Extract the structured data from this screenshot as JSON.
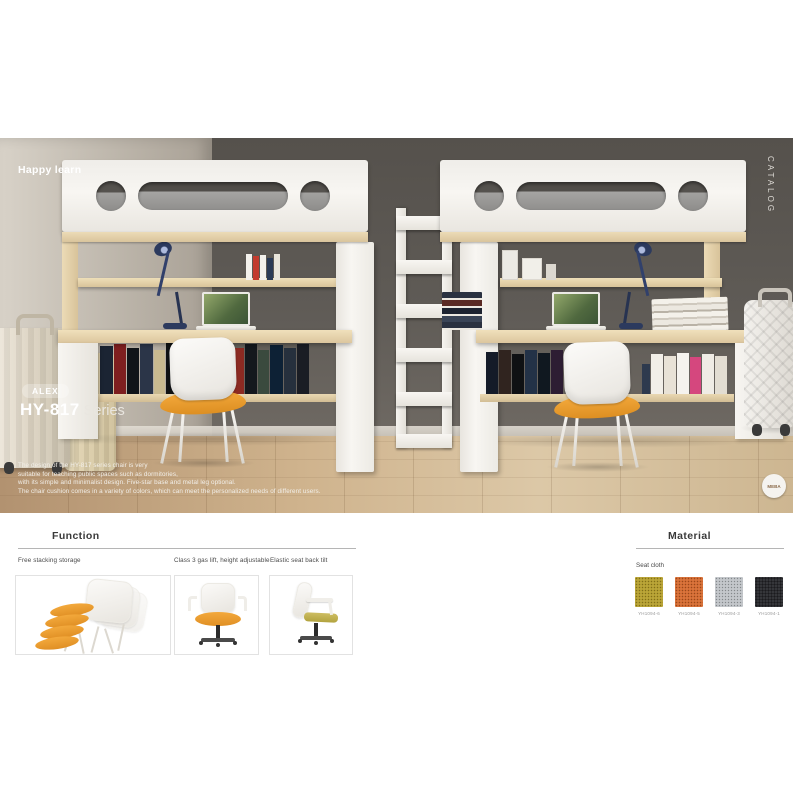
{
  "photo": {
    "tagline": "Happy learn",
    "catalog_label": "CATALOG",
    "series_badge": "ALEX",
    "series_code": "HY-817",
    "series_suffix": "Series",
    "description_lines": [
      "The design of the HY-817 series chair is very",
      "suitable for teaching public spaces such as dormitories,",
      "with its simple and minimalist design. Five-star base and metal leg optional.",
      "The chair cushion comes in a variety of colors, which can meet the personalized needs of different users."
    ],
    "logo_text": "MEBA",
    "palette": {
      "wall_dark": "#5f5b56",
      "wall_light": "#c2bbb0",
      "floor_wood": "#cbb28d",
      "furniture_white": "#f5f3ef",
      "wood_maple": "#e6d4ae",
      "seat_orange": "#f0a13c",
      "lamp_navy": "#2c3a5e",
      "mattress_gray": "#9a9a9a"
    }
  },
  "function_section": {
    "title": "Function",
    "items": [
      {
        "caption": "Free stacking storage"
      },
      {
        "caption": "Class 3 gas lift, height adjustable"
      },
      {
        "caption": "Elastic seat back tilt"
      }
    ]
  },
  "material_section": {
    "title": "Material",
    "subtitle": "Seat cloth",
    "swatches": [
      {
        "label": "YH1094-6",
        "color": "#b49e2c"
      },
      {
        "label": "YH1094-5",
        "color": "#d4692f"
      },
      {
        "label": "YH1094-3",
        "color": "#bfc3c7"
      },
      {
        "label": "YH1094-1",
        "color": "#26272b"
      }
    ]
  }
}
